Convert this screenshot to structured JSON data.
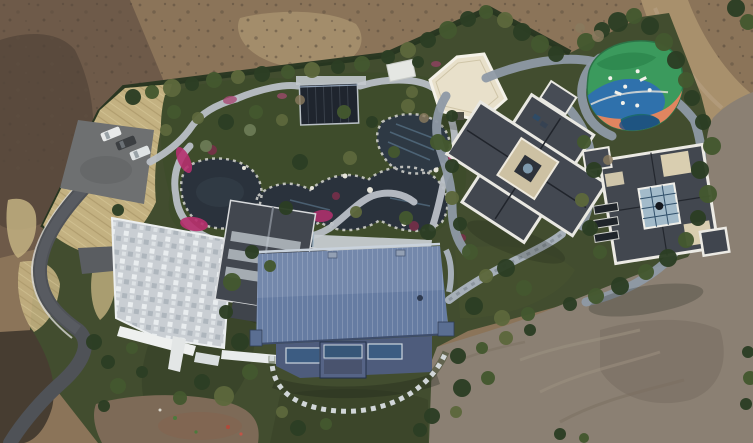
{
  "scene": {
    "title": "Aerial drone view of a landscaped estate compound",
    "description": "Bird's-eye photograph of a private estate: winding garden ponds with stone paths and magenta flower beds, a large blue-roofed central villa, a slate-roofed west house with stone plaza, two gray cross-shaped villas to the east, a colorful children's playground, a parking pad with cars, all ringed by hedges, trees and bare graded earth",
    "vehicle_count": 3,
    "building_count": 5,
    "pond_count": 3
  },
  "colors": {
    "dirt_field": "#8b7459",
    "dirt_dark": "#6a5847",
    "dirt_blotch": "#544639",
    "dirt_sand": "#a9946f",
    "dirt_road": "#a8906c",
    "dirt_graded": "#8b8073",
    "dirt_tracks": "#9d9182",
    "soil_dark": "#473d31",
    "soil_patch": "#7d6a57",
    "soil_red": "#8a5f4a",
    "lawn": "#424d2f",
    "lawn_shade": "#353f26",
    "hedge": "#263520",
    "tree_dark": "#2c3e24",
    "tree_mid": "#44582f",
    "tree_olive": "#5d683c",
    "tree_bare": "#8a7a5e",
    "tree_gray": "#6b7a55",
    "dry_grass": "#c3b181",
    "asphalt": "#4f5257",
    "parking": "#6e7071",
    "stone_path": "#b9bfc6",
    "stone_plaza": "#cfd4d8",
    "walk_path": "#8e99a5",
    "terrace": "#c6cbd0",
    "pond": "#2a323c",
    "pond_glint": "#6b8da6",
    "pool": "#3f6a8e",
    "flowers": "#b5306e",
    "roof_blue": "#667ca2",
    "roof_blue_light": "#7f92b2",
    "facade_blue": "#4e5c7c",
    "glass_blue": "#3c5c82",
    "roof_slate": "#42474f",
    "roof_trim": "#eceae4",
    "roof_cream": "#e8e0ca",
    "skylight_cream": "#d9ceb0",
    "atrium": "#a3bbca",
    "pavilion_dark": "#1f252e",
    "pg_green": "#3b9a5d",
    "pg_blue": "#2e6fb0",
    "pg_orange": "#e08560",
    "pg_teal": "#1d6a70",
    "car_white": "#e8eaea",
    "car_dark": "#3c3f42",
    "wall_white": "#eef0ef",
    "step_white": "#d9dee1"
  }
}
